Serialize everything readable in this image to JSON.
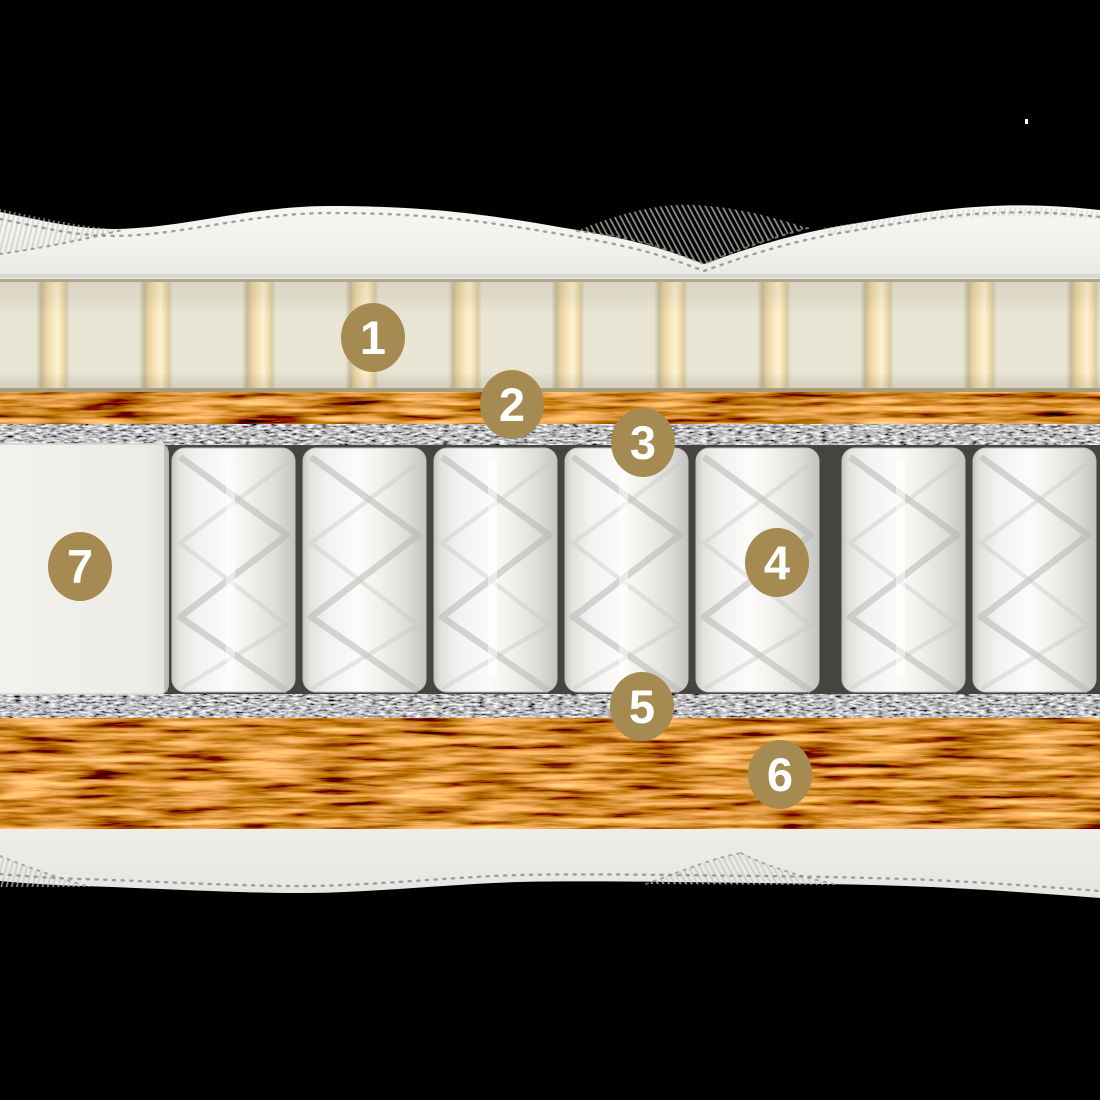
{
  "badges": {
    "fill_color": "#a58b52",
    "text_color": "#ffffff",
    "items": [
      {
        "id": "marker-1",
        "label": "1"
      },
      {
        "id": "marker-2",
        "label": "2"
      },
      {
        "id": "marker-3",
        "label": "3"
      },
      {
        "id": "marker-4",
        "label": "4"
      },
      {
        "id": "marker-5",
        "label": "5"
      },
      {
        "id": "marker-6",
        "label": "6"
      },
      {
        "id": "marker-7",
        "label": "7"
      }
    ]
  },
  "palette": {
    "background": "#000000",
    "cover_fabric": "#f3f2ef",
    "latex_layer": "#e9e5d4",
    "latex_groove": "#f8e7bf",
    "coir_layer": "#8c4d22",
    "felt_layer": "#6e6e6e",
    "spring_pocket": "#f7f7f5",
    "edge_foam": "#efeeea",
    "badge": "#a58b52"
  }
}
